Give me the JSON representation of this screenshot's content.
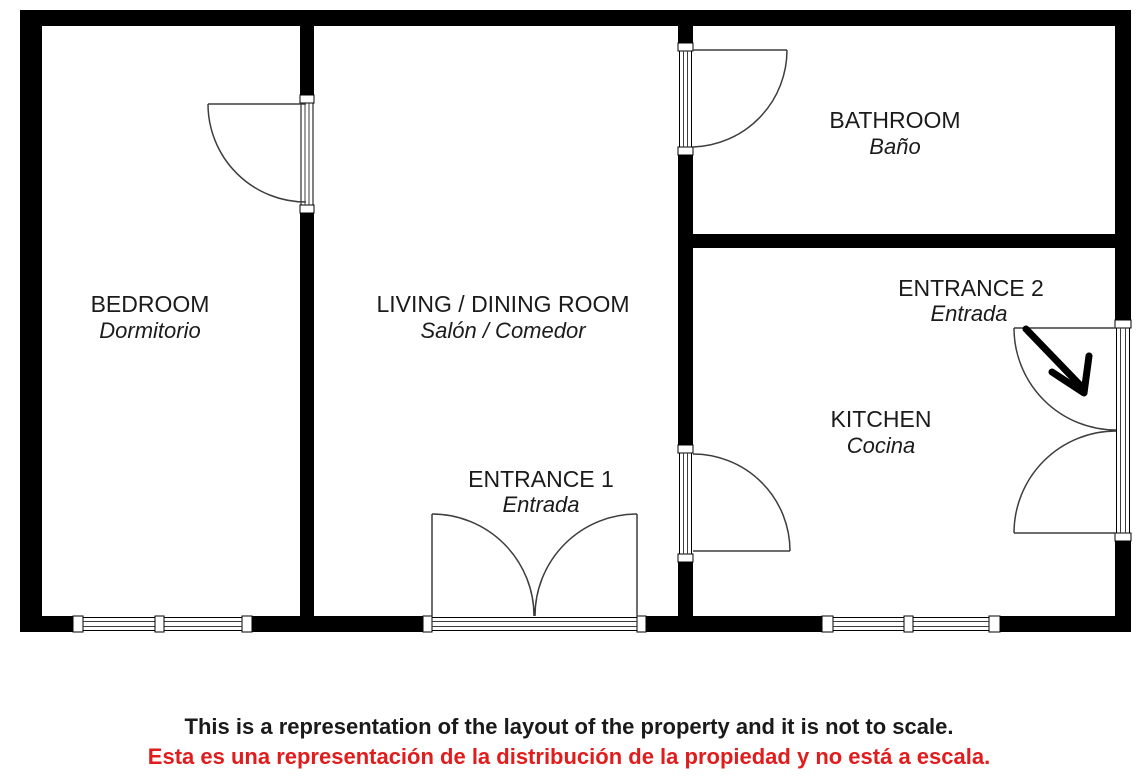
{
  "plan": {
    "title": "Property floor plan",
    "rooms": [
      {
        "id": "bedroom",
        "name": "BEDROOM",
        "name_es": "Dormitorio"
      },
      {
        "id": "living",
        "name": "LIVING / DINING ROOM",
        "name_es": "Salón / Comedor"
      },
      {
        "id": "bathroom",
        "name": "BATHROOM",
        "name_es": "Baño"
      },
      {
        "id": "kitchen",
        "name": "KITCHEN",
        "name_es": "Cocina"
      }
    ],
    "entrances": [
      {
        "id": "entrance1",
        "name": "ENTRANCE 1",
        "name_es": "Entrada"
      },
      {
        "id": "entrance2",
        "name": "ENTRANCE 2",
        "name_es": "Entrada",
        "arrow_icon": "diagonal-arrow-down-right"
      }
    ],
    "features": {
      "doors": [
        "bedroom-door",
        "bathroom-door",
        "kitchen-door",
        "entrance-1-double-door",
        "entrance-2-double-door"
      ],
      "windows": [
        "bedroom-window",
        "kitchen-window"
      ]
    }
  },
  "disclaimer": {
    "en": "This is a representation of the layout of the property and it is not to scale.",
    "es": "Esta es una representación de la distribución de la propiedad y no está a escala."
  },
  "colors": {
    "wall": "#000000",
    "background": "#ffffff",
    "label_text": "#1b1b1b",
    "disclaimer_red": "#e11c1c",
    "line_gray": "#3d3d3d"
  }
}
